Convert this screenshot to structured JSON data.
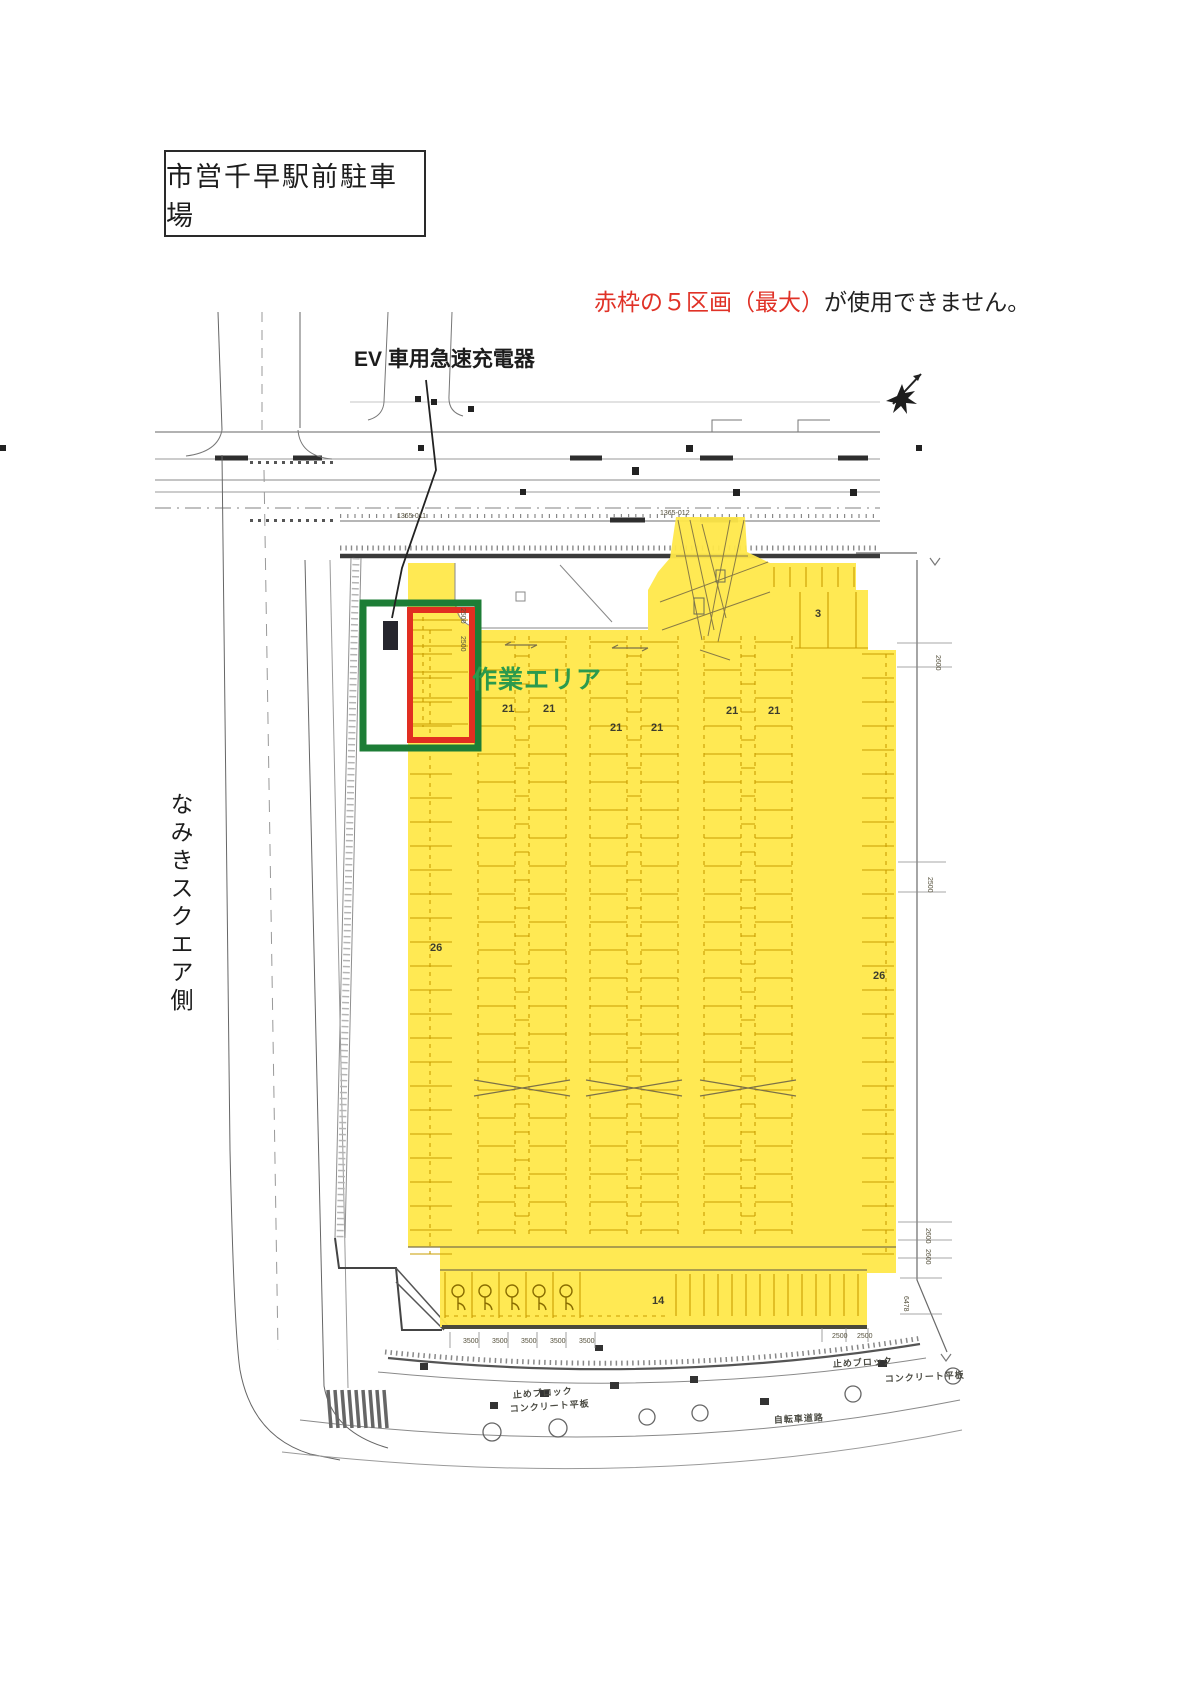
{
  "title": "市営千早駅前駐車場",
  "notice": {
    "red": "赤枠の５区画（最大）",
    "rest": "が使用できません。"
  },
  "annotations": {
    "ev_charger_label": "EV 車用急速充電器",
    "work_area_label": "作業エリア",
    "street_side_label": "なみきスクエア側"
  },
  "colors": {
    "highlight_yellow": "#ffe84a",
    "stall_line_orange": "#c99d00",
    "green_box": "#1d7d36",
    "red_box": "#e12e21",
    "work_area_text_green": "#2b9a4d",
    "notice_red": "#e03227"
  },
  "plan": {
    "stall_counts": [
      {
        "t": "3",
        "x": 815,
        "y": 617
      },
      {
        "t": "21",
        "x": 502,
        "y": 712
      },
      {
        "t": "21",
        "x": 543,
        "y": 712
      },
      {
        "t": "21",
        "x": 610,
        "y": 731
      },
      {
        "t": "21",
        "x": 651,
        "y": 731
      },
      {
        "t": "21",
        "x": 726,
        "y": 714
      },
      {
        "t": "21",
        "x": 768,
        "y": 714
      },
      {
        "t": "26",
        "x": 430,
        "y": 951
      },
      {
        "t": "26",
        "x": 873,
        "y": 979
      },
      {
        "t": "14",
        "x": 652,
        "y": 1304
      }
    ],
    "dimensions": [
      {
        "t": "2500",
        "x": 461,
        "y": 608,
        "rot": 90
      },
      {
        "t": "2500",
        "x": 461,
        "y": 636,
        "rot": 90
      },
      {
        "t": "2600",
        "x": 936,
        "y": 655,
        "rot": 90
      },
      {
        "t": "2500",
        "x": 928,
        "y": 877,
        "rot": 90
      },
      {
        "t": "2600",
        "x": 926,
        "y": 1228,
        "rot": 90
      },
      {
        "t": "2600",
        "x": 926,
        "y": 1249,
        "rot": 90
      },
      {
        "t": "6478",
        "x": 904,
        "y": 1296,
        "rot": 90
      },
      {
        "t": "3500",
        "x": 463,
        "y": 1343,
        "rot": 0
      },
      {
        "t": "3500",
        "x": 492,
        "y": 1343,
        "rot": 0
      },
      {
        "t": "3500",
        "x": 521,
        "y": 1343,
        "rot": 0
      },
      {
        "t": "3500",
        "x": 550,
        "y": 1343,
        "rot": 0
      },
      {
        "t": "3500",
        "x": 579,
        "y": 1343,
        "rot": 0
      },
      {
        "t": "2500",
        "x": 832,
        "y": 1338,
        "rot": 0
      },
      {
        "t": "2500",
        "x": 857,
        "y": 1338,
        "rot": 0
      },
      {
        "t": "1365-011",
        "x": 397,
        "y": 518,
        "rot": 0
      },
      {
        "t": "1365-012",
        "x": 660,
        "y": 515,
        "rot": 0
      }
    ],
    "road_labels": [
      {
        "t": "止めブロック",
        "x": 513,
        "y": 1398,
        "rot": -4
      },
      {
        "t": "コンクリート平板",
        "x": 510,
        "y": 1412,
        "rot": -4
      },
      {
        "t": "止めブロック",
        "x": 833,
        "y": 1367,
        "rot": -3
      },
      {
        "t": "コンクリート平板",
        "x": 885,
        "y": 1382,
        "rot": -3
      },
      {
        "t": "自転車道路",
        "x": 774,
        "y": 1423,
        "rot": -3
      }
    ]
  }
}
